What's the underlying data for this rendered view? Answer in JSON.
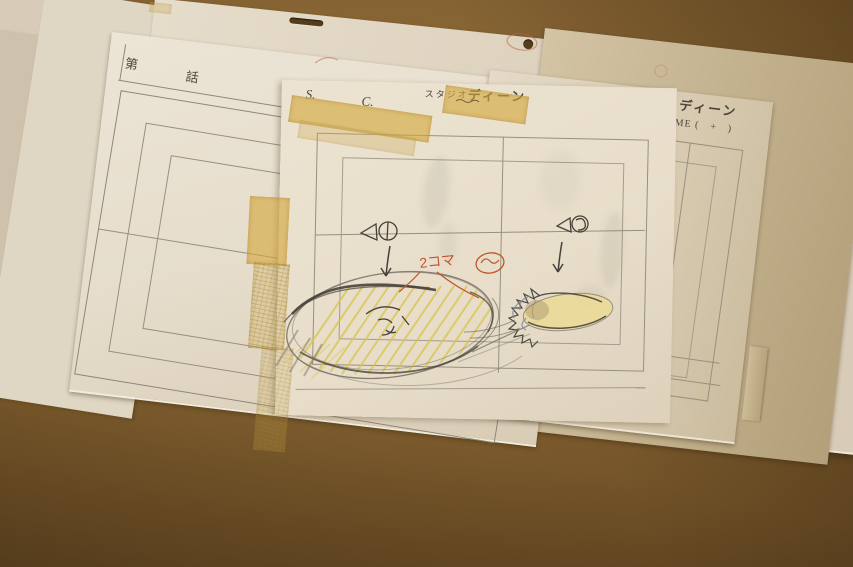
{
  "scene": {
    "description": "Photograph of hand-drawn anime production layout sheets from Studio DEEN, taped together with yellow masking tape and lying on a brown desk"
  },
  "colors": {
    "desk": "#7e5d2e",
    "paper": "#e7ddc9",
    "tape": "#d2a845",
    "pencil": "#5f594e",
    "orange_pencil": "#c0552b",
    "yellow_pencil": "#d9c54e",
    "red_pencil": "#b4654c"
  },
  "sheet_left": {
    "episode_prefix": "第",
    "episode_suffix": "話"
  },
  "sheet_middle": {
    "scene_label": "S.",
    "cut_label": "C.",
    "studio_prefix": "スタジオ",
    "studio_name": "ディーン"
  },
  "sheet_right": {
    "scene_label": "S.",
    "cut_label": "C.",
    "studio_prefix": "スタジオ",
    "studio_name": "ディーン",
    "time_label": "TIME (　+　)"
  },
  "annotations": {
    "timing_note": "2コマ"
  }
}
